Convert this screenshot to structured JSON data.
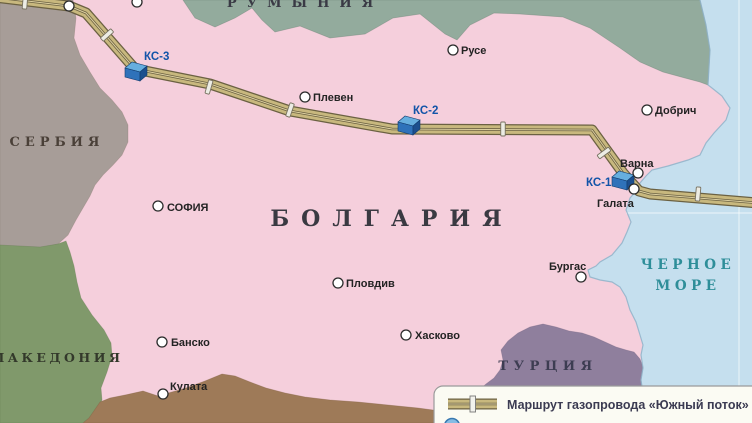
{
  "regions": {
    "bulgaria": {
      "label": "БОЛГАРИЯ",
      "color": "#f5cfdc",
      "label_color": "#3a3a42"
    },
    "serbia": {
      "label": "СЕРБИЯ",
      "color": "#a79d98",
      "label_color": "#4a4038"
    },
    "romania": {
      "label": "РУМЫНИЯ",
      "color": "#93ab9d",
      "label_color": "#3a3a45"
    },
    "macedonia": {
      "label": "МАКЕДОНИЯ",
      "color": "#80996b",
      "label_color": "#33392b"
    },
    "turkey": {
      "label": "ТУРЦИЯ",
      "color": "#8f7f9d",
      "label_color": "#3d3d52"
    },
    "greece": {
      "label": "",
      "color": "#9e7a58"
    },
    "sea": {
      "label_line1": "ЧЕРНОЕ",
      "label_line2": "МОРЕ",
      "color": "#c5dfee",
      "label_color": "#2e8e99"
    }
  },
  "cities": [
    {
      "id": "nw-1",
      "label": "",
      "x": 69,
      "y": 6,
      "lx": 0,
      "ly": 0
    },
    {
      "id": "nw-2",
      "label": "",
      "x": 137,
      "y": 2,
      "lx": 0,
      "ly": 0
    },
    {
      "id": "ruse",
      "label": "Русе",
      "x": 453,
      "y": 50,
      "lx": 461,
      "ly": 54
    },
    {
      "id": "pleven",
      "label": "Плевен",
      "x": 305,
      "y": 97,
      "lx": 313,
      "ly": 101
    },
    {
      "id": "dobrich",
      "label": "Добрич",
      "x": 647,
      "y": 110,
      "lx": 655,
      "ly": 114
    },
    {
      "id": "varna",
      "label": "Варна",
      "x": 638,
      "y": 173,
      "lx": 620,
      "ly": 167
    },
    {
      "id": "galata",
      "label": "Галата",
      "x": 634,
      "y": 189,
      "lx": 597,
      "ly": 207
    },
    {
      "id": "sofia",
      "label": "СОФИЯ",
      "x": 158,
      "y": 206,
      "lx": 167,
      "ly": 211
    },
    {
      "id": "plovdiv",
      "label": "Пловдив",
      "x": 338,
      "y": 283,
      "lx": 346,
      "ly": 287
    },
    {
      "id": "burgas",
      "label": "Бургас",
      "x": 581,
      "y": 277,
      "lx": 549,
      "ly": 270
    },
    {
      "id": "haskovo",
      "label": "Хасково",
      "x": 406,
      "y": 335,
      "lx": 415,
      "ly": 339
    },
    {
      "id": "bansko",
      "label": "Банско",
      "x": 162,
      "y": 342,
      "lx": 171,
      "ly": 346
    },
    {
      "id": "kulata",
      "label": "Кулата",
      "x": 163,
      "y": 394,
      "lx": 170,
      "ly": 390
    }
  ],
  "stations": [
    {
      "id": "ks-3",
      "label": "КС-3",
      "x": 136,
      "y": 71,
      "lx": 144,
      "ly": 60
    },
    {
      "id": "ks-2",
      "label": "КС-2",
      "x": 409,
      "y": 125,
      "lx": 413,
      "ly": 114
    },
    {
      "id": "ks-1",
      "label": "КС-1",
      "x": 623,
      "y": 180,
      "lx": 586,
      "ly": 186
    }
  ],
  "pipeline": {
    "fill": "#c8b87e",
    "outline": "#6b6142",
    "joints": [
      {
        "x": 25,
        "y": 2,
        "a": 5
      },
      {
        "x": 107,
        "y": 35,
        "a": 48
      },
      {
        "x": 209,
        "y": 87,
        "a": 16
      },
      {
        "x": 290,
        "y": 110,
        "a": 19
      },
      {
        "x": 503,
        "y": 129,
        "a": 0
      },
      {
        "x": 604,
        "y": 153,
        "a": 54
      },
      {
        "x": 698,
        "y": 194,
        "a": 5
      }
    ]
  },
  "legend": {
    "items": [
      {
        "symbol": "pipeline-symbol",
        "label": "Маршрут газопровода «Южный поток»"
      },
      {
        "symbol": "blue-circle",
        "label": ""
      }
    ]
  }
}
